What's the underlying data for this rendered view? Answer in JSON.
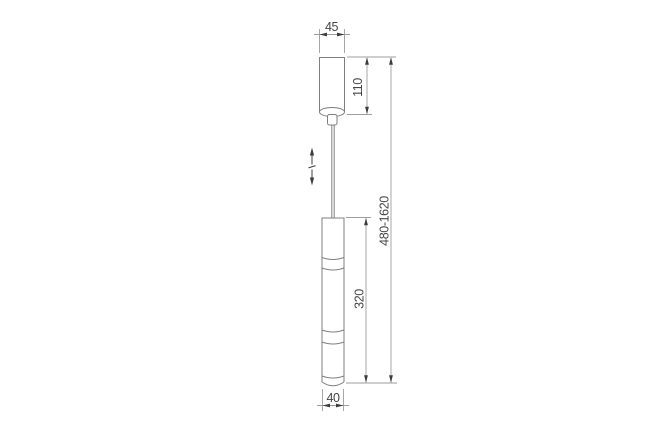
{
  "drawing": {
    "kind": "technical dimension drawing of a pendant luminaire",
    "colors": {
      "background": "#ffffff",
      "object_line": "#7f7f7f",
      "dimension_line": "#9e9e9e",
      "arrow_and_text": "#3c3c3c"
    },
    "labels": {
      "canopy_width": "45",
      "canopy_height": "110",
      "overall_height_range": "480-1620",
      "shade_length": "320",
      "shade_diameter": "40"
    },
    "icons": [
      {
        "name": "height-adjustable-arrow-icon"
      }
    ]
  }
}
